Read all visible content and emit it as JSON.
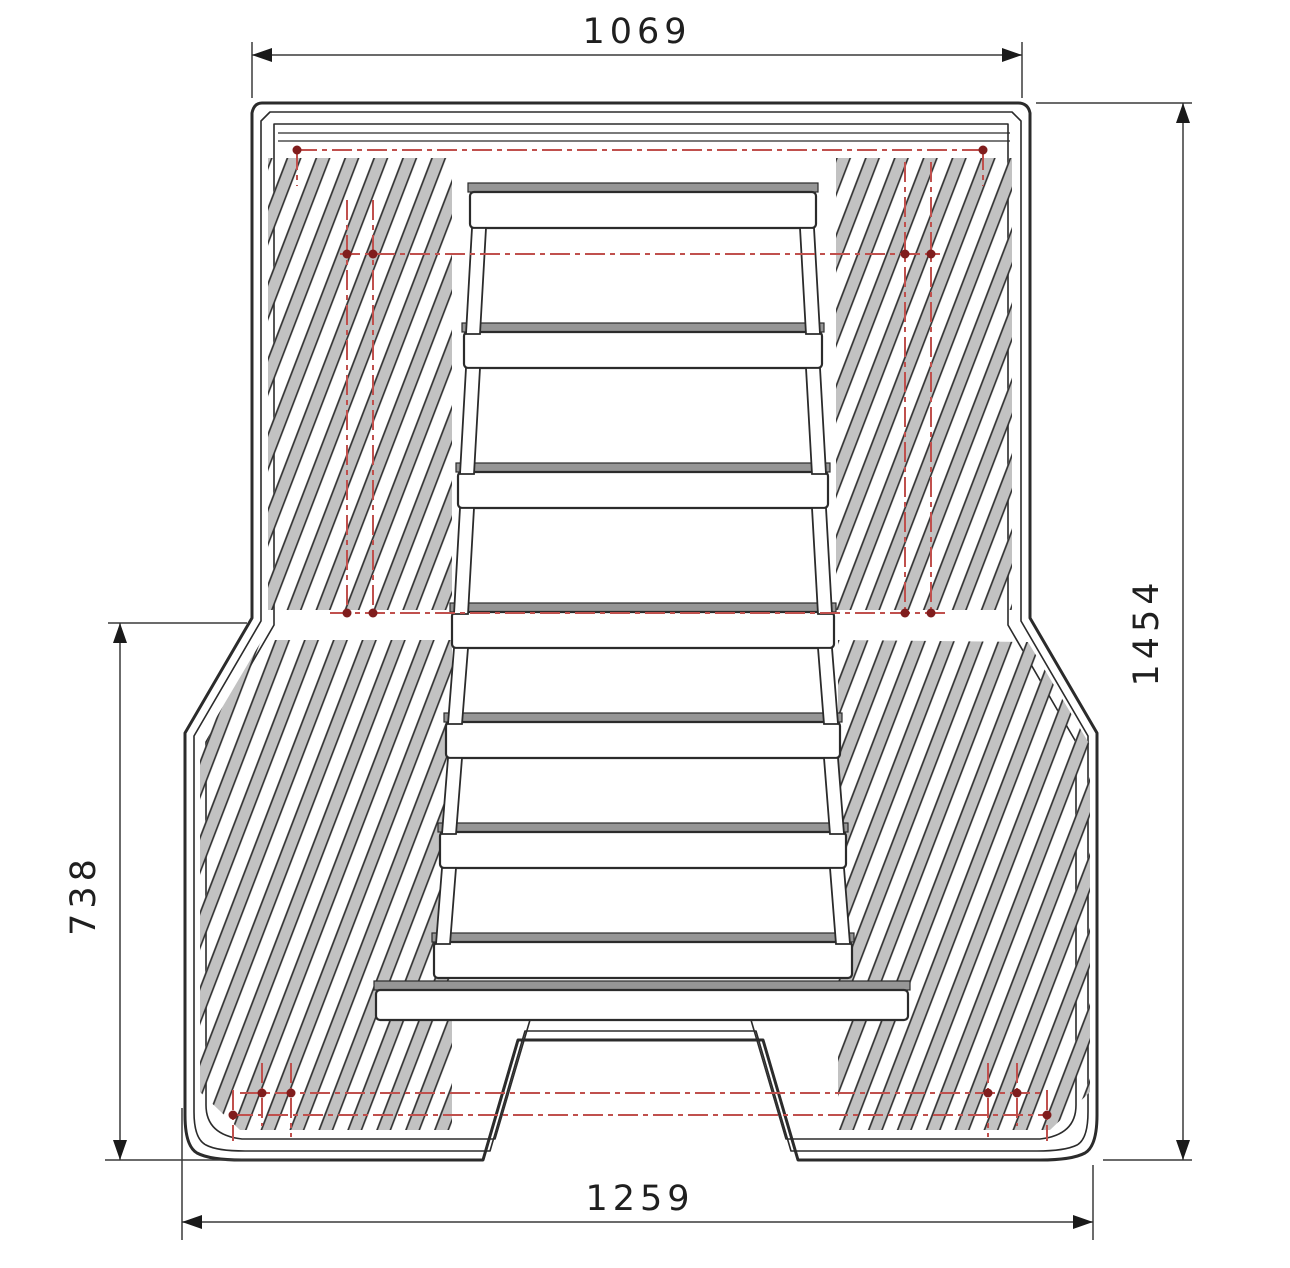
{
  "drawing": {
    "kind": "technical-drawing-top-view",
    "subject": "ribbed-bed-liner-panel",
    "dimensions": {
      "top_width": "1069",
      "overall_height": "1454",
      "lower_section_height": "738",
      "bottom_width": "1259"
    },
    "colors": {
      "outline": "#2b2b2b",
      "dimension_line": "#3a3a3a",
      "centerline_red": "#c0504d",
      "centerline_dot": "#801d1d",
      "rib_fill": "#c2c2c2",
      "step_shadow": "#969696",
      "background": "#ffffff"
    }
  }
}
